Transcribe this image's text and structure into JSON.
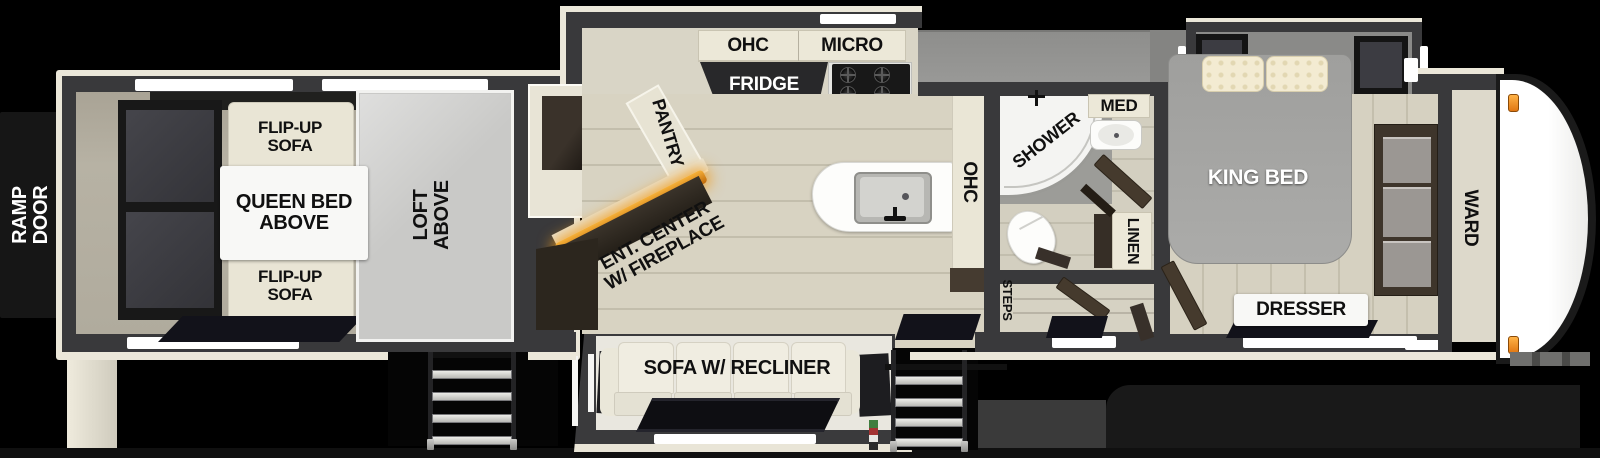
{
  "labels": {
    "ramp_door": "RAMP DOOR",
    "flip_up_sofa_top": "FLIP-UP SOFA",
    "flip_up_sofa_bottom": "FLIP-UP SOFA",
    "queen_bed_above": "QUEEN BED ABOVE",
    "loft_above": "LOFT ABOVE",
    "pantry": "PANTRY",
    "ohc_kitchen": "OHC",
    "micro": "MICRO",
    "fridge": "FRIDGE",
    "ent_center": "ENT. CENTER W/ FIREPLACE",
    "ohc_island": "OHC",
    "shower": "SHOWER",
    "med": "MED",
    "linen": "LINEN",
    "steps": "STEPS",
    "king_bed": "KING BED",
    "dresser": "DRESSER",
    "ward": "WARD",
    "sofa_recliner": "SOFA W/ RECLINER"
  },
  "colors": {
    "background": "#000000",
    "wall": "#39393b",
    "trim": "#ebe7d9",
    "floor_wood": "#d8d3c2",
    "garage_floor": "#b2ada0",
    "loft_gray": "#c9c9c7",
    "roof_gray": "#8e8e8c",
    "bed_gray": "#a7a7a5",
    "furniture_dark_brown": "#453a2d",
    "fridge_dark": "#28282a",
    "label_text": "#101010",
    "label_text_light": "#ffffff",
    "fireplace_glow": "#f59d1e",
    "marker_light": "#f08222",
    "stove_knob_red": "#cf1717"
  }
}
